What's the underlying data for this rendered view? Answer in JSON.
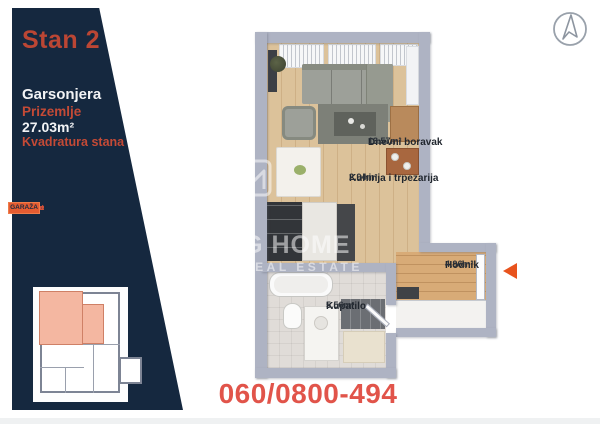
{
  "sidebar": {
    "title": "Stan 2",
    "unit_type": "Garsonjera",
    "floor": "Prizemlje",
    "area": "27.03m²",
    "area_caption": "Kvadratura stana",
    "floors_table": {
      "rows": [
        {
          "label": "Potkrovlje",
          "cells": [
            {
              "label": "STAN 8"
            },
            {
              "label": "STAN 9"
            }
          ]
        },
        {
          "label": "2. Sprat",
          "cells": [
            {
              "label": "STAN 6"
            },
            {
              "label": "STAN 7"
            }
          ]
        },
        {
          "label": "1. Sprat",
          "cells": [
            {
              "label": "STAN 4"
            },
            {
              "label": "STAN 5"
            }
          ]
        },
        {
          "label": "Prizemlje",
          "cells": [
            {
              "label": "STAN 1"
            },
            {
              "label": "STAN 2"
            },
            {
              "label": "STAN 3"
            }
          ]
        },
        {
          "label": "Podrum",
          "cells": [
            {
              "label": "GARAŽA"
            }
          ]
        }
      ],
      "active_cell": "STAN 2"
    }
  },
  "floor_plan": {
    "rooms": [
      {
        "name": "Dnevni boravak",
        "area": "13.57m²"
      },
      {
        "name": "Kuhinja i trpezarija",
        "area": "2.94m²"
      },
      {
        "name": "Kupatilo",
        "area": "5.56m²"
      },
      {
        "name": "Hodnik",
        "area": "4.96m²"
      }
    ]
  },
  "watermark": {
    "brand_line1": "BG HOME",
    "brand_line2": "REAL ESTATE"
  },
  "contact": {
    "phone": "060/0800-494"
  },
  "colors": {
    "sidebar_navy": "#15283f",
    "cell_orange": "#e55c31",
    "brick_red": "#bb4634",
    "phone_red": "#e1544a",
    "arrow_orange": "#e8531d",
    "highlight_salmon": "#f4b7a1",
    "wall_gray": "#aeb3c3"
  }
}
